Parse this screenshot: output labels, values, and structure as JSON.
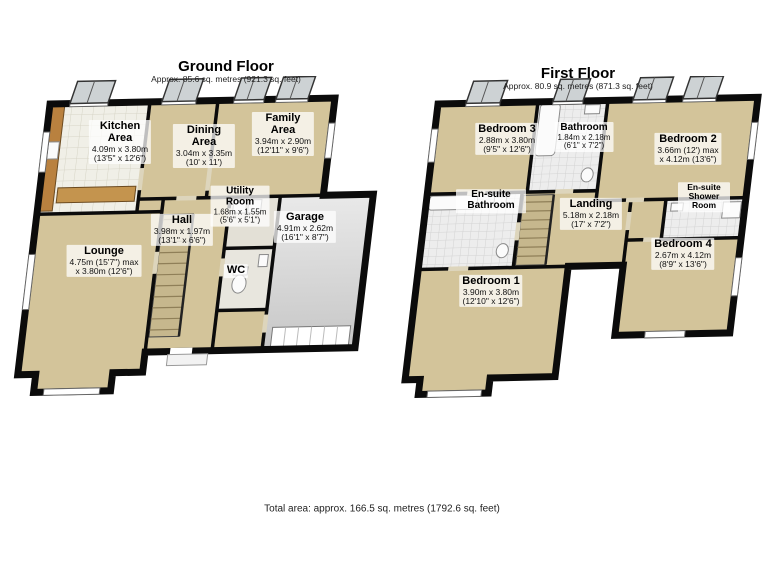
{
  "page": {
    "background": "#ffffff",
    "total_area_note": "Total area: approx. 166.5 sq. metres (1792.6 sq. feet)"
  },
  "colors": {
    "wall": "#0b0b0b",
    "floor_tan": "#d3c49a",
    "garage_floor": "#d8d8d8",
    "tile_white": "#f0efe7",
    "counter_wood": "#b9813f"
  },
  "ground_floor": {
    "title": "Ground Floor",
    "subtitle": "Approx. 85.6 sq. metres (921.3 sq. feet)",
    "rooms": {
      "kitchen": {
        "name": "Kitchen Area",
        "dims_m": "4.09m x 3.80m",
        "dims_ft": "(13'5\" x 12'6\")"
      },
      "dining": {
        "name": "Dining Area",
        "dims_m": "3.04m x 3.35m",
        "dims_ft": "(10' x 11')"
      },
      "family": {
        "name": "Family Area",
        "dims_m": "3.94m x 2.90m",
        "dims_ft": "(12'11\" x 9'6\")"
      },
      "hall": {
        "name": "Hall",
        "dims_m": "3.98m x 1.97m",
        "dims_ft": "(13'1\" x 6'6\")"
      },
      "utility": {
        "name": "Utility Room",
        "dims_m": "1.68m x 1.55m",
        "dims_ft": "(5'6\" x 5'1\")"
      },
      "garage": {
        "name": "Garage",
        "dims_m": "4.91m x 2.62m",
        "dims_ft": "(16'1\" x 8'7\")"
      },
      "lounge": {
        "name": "Lounge",
        "dims_m": "4.75m (15'7\") max",
        "dims_ft": "x 3.80m (12'6\")"
      },
      "wc": {
        "name": "WC"
      }
    }
  },
  "first_floor": {
    "title": "First Floor",
    "subtitle": "Approx. 80.9 sq. metres (871.3 sq. feet)",
    "rooms": {
      "bedroom3": {
        "name": "Bedroom 3",
        "dims_m": "2.88m x 3.80m",
        "dims_ft": "(9'5\" x 12'6\")"
      },
      "bathroom": {
        "name": "Bathroom",
        "dims_m": "1.84m x 2.18m",
        "dims_ft": "(6'1\" x 7'2\")"
      },
      "bedroom2": {
        "name": "Bedroom 2",
        "dims_m": "3.66m (12') max",
        "dims_ft": "x 4.12m (13'6\")"
      },
      "ensuite_bathroom": {
        "name": "En-suite Bathroom"
      },
      "landing": {
        "name": "Landing",
        "dims_m": "5.18m x 2.18m",
        "dims_ft": "(17' x 7'2\")"
      },
      "ensuite_shower": {
        "name": "En-suite Shower Room"
      },
      "bedroom4": {
        "name": "Bedroom 4",
        "dims_m": "2.67m x 4.12m",
        "dims_ft": "(8'9\" x 13'6\")"
      },
      "bedroom1": {
        "name": "Bedroom 1",
        "dims_m": "3.90m x 3.80m",
        "dims_ft": "(12'10\" x 12'6\")"
      }
    }
  }
}
